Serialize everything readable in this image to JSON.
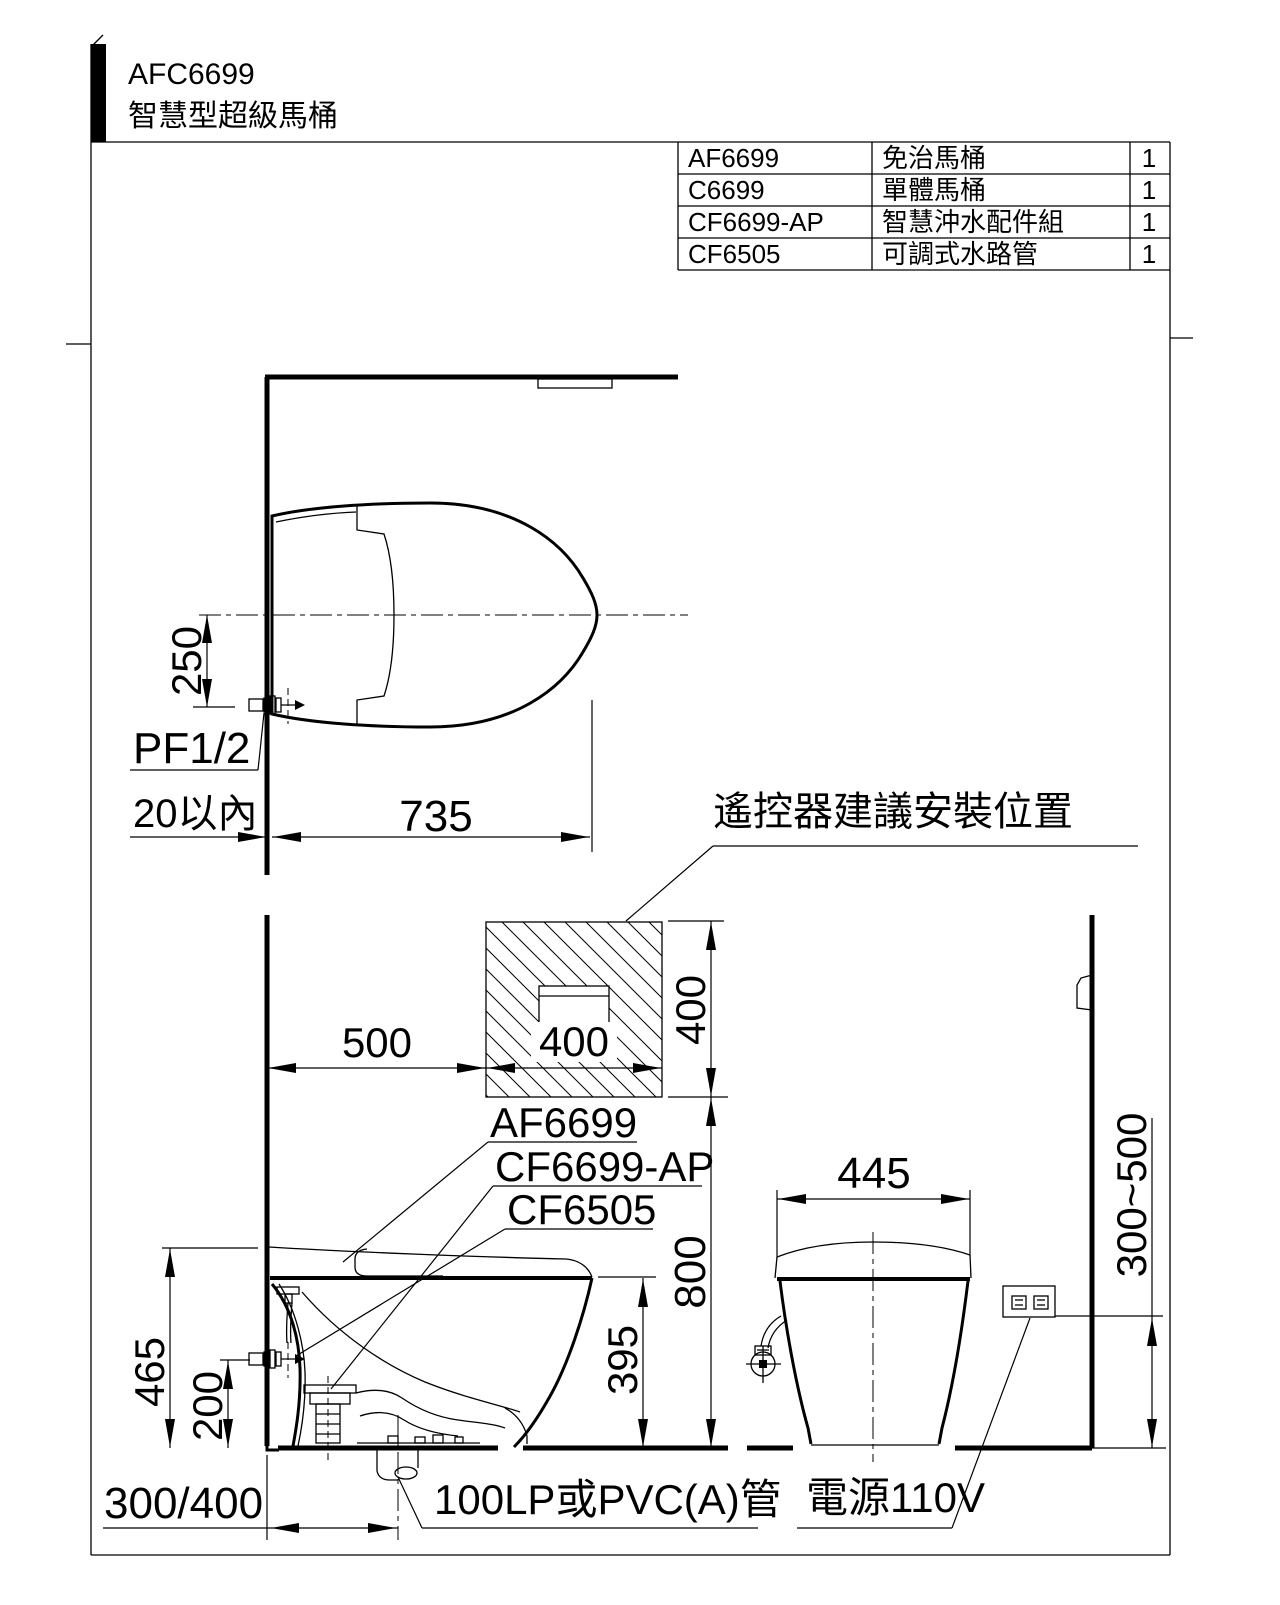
{
  "page": {
    "title_model": "AFC6699",
    "title_name": "智慧型超級馬桶"
  },
  "parts_table": {
    "rows": [
      {
        "model": "AF6699",
        "name": "免治馬桶",
        "qty": "1"
      },
      {
        "model": "C6699",
        "name": "單體馬桶",
        "qty": "1"
      },
      {
        "model": "CF6699-AP",
        "name": "智慧沖水配件組",
        "qty": "1"
      },
      {
        "model": "CF6505",
        "name": "可調式水路管",
        "qty": "1"
      }
    ]
  },
  "top_view": {
    "dim_250": "250",
    "label_inlet": "PF1/2",
    "dim_wall_gap": "20以內",
    "dim_length": "735"
  },
  "remote_zone": {
    "label": "遙控器建議安裝位置",
    "dim_offset": "500",
    "dim_width": "400",
    "dim_height": "400"
  },
  "side_view": {
    "label_seat": "AF6699",
    "label_flush_kit": "CF6699-AP",
    "label_water_pipe": "CF6505",
    "dim_total_height": "465",
    "dim_inlet_height": "200",
    "dim_bowl_height": "395",
    "dim_remote_height": "800",
    "dim_rough_in": "300/400",
    "label_drain": "100LP或PVC(A)管"
  },
  "rear_view": {
    "dim_width": "445",
    "dim_outlet_height": "300~500",
    "label_power": "電源110V"
  },
  "colors": {
    "line": "#000000",
    "background": "#ffffff"
  }
}
